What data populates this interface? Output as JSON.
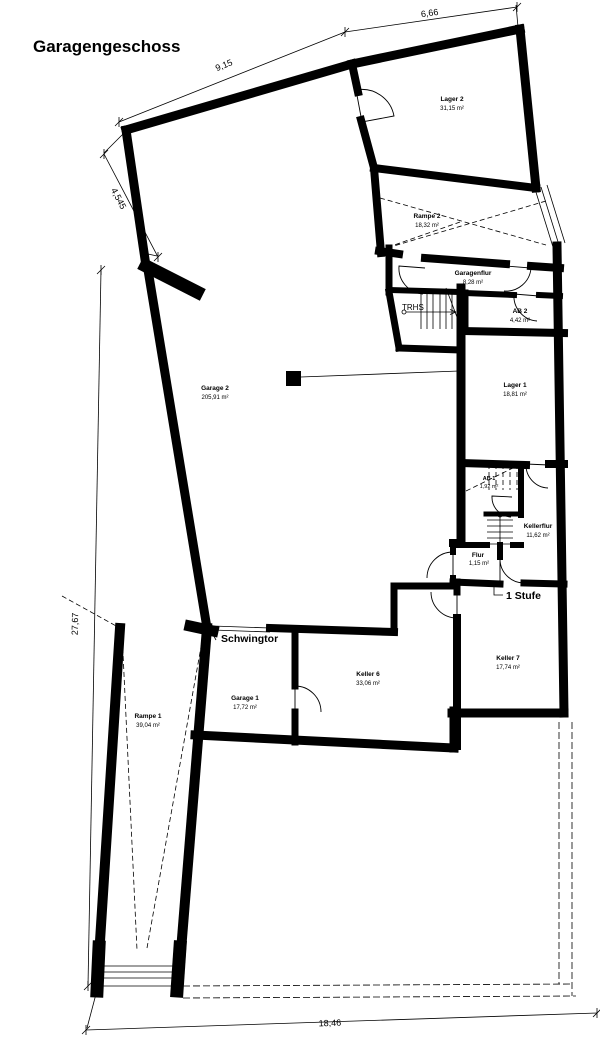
{
  "title": "Garagengeschoss",
  "rooms": [
    {
      "name": "Lager 2",
      "area": "31,15 m²"
    },
    {
      "name": "Rampe 2",
      "area": "18,32 m²"
    },
    {
      "name": "Garagenflur",
      "area": "8,28 m²"
    },
    {
      "name": "AB 2",
      "area": "4,42 m²"
    },
    {
      "name": "Garage 2",
      "area": "205,91 m²"
    },
    {
      "name": "Lager 1",
      "area": "18,81 m²"
    },
    {
      "name": "AB 1",
      "area": "1,92 m²"
    },
    {
      "name": "Kellerflur",
      "area": "11,62 m²"
    },
    {
      "name": "Flur",
      "area": "1,15 m²"
    },
    {
      "name": "Garage 1",
      "area": "17,72 m²"
    },
    {
      "name": "Keller 6",
      "area": "33,06 m²"
    },
    {
      "name": "Keller 7",
      "area": "17,74 m²"
    },
    {
      "name": "Rampe 1",
      "area": "39,04 m²"
    }
  ],
  "annotations": {
    "stairwell": "TRHS",
    "garage_door": "Schwingtor",
    "step": "1 Stufe"
  },
  "dimensions": {
    "nw_diagonal": "9,15",
    "north": "6,66",
    "west_diagonal": "4,545",
    "west": "27,67",
    "south": "18,46"
  },
  "colors": {
    "wall": "#000000",
    "background": "#ffffff"
  }
}
